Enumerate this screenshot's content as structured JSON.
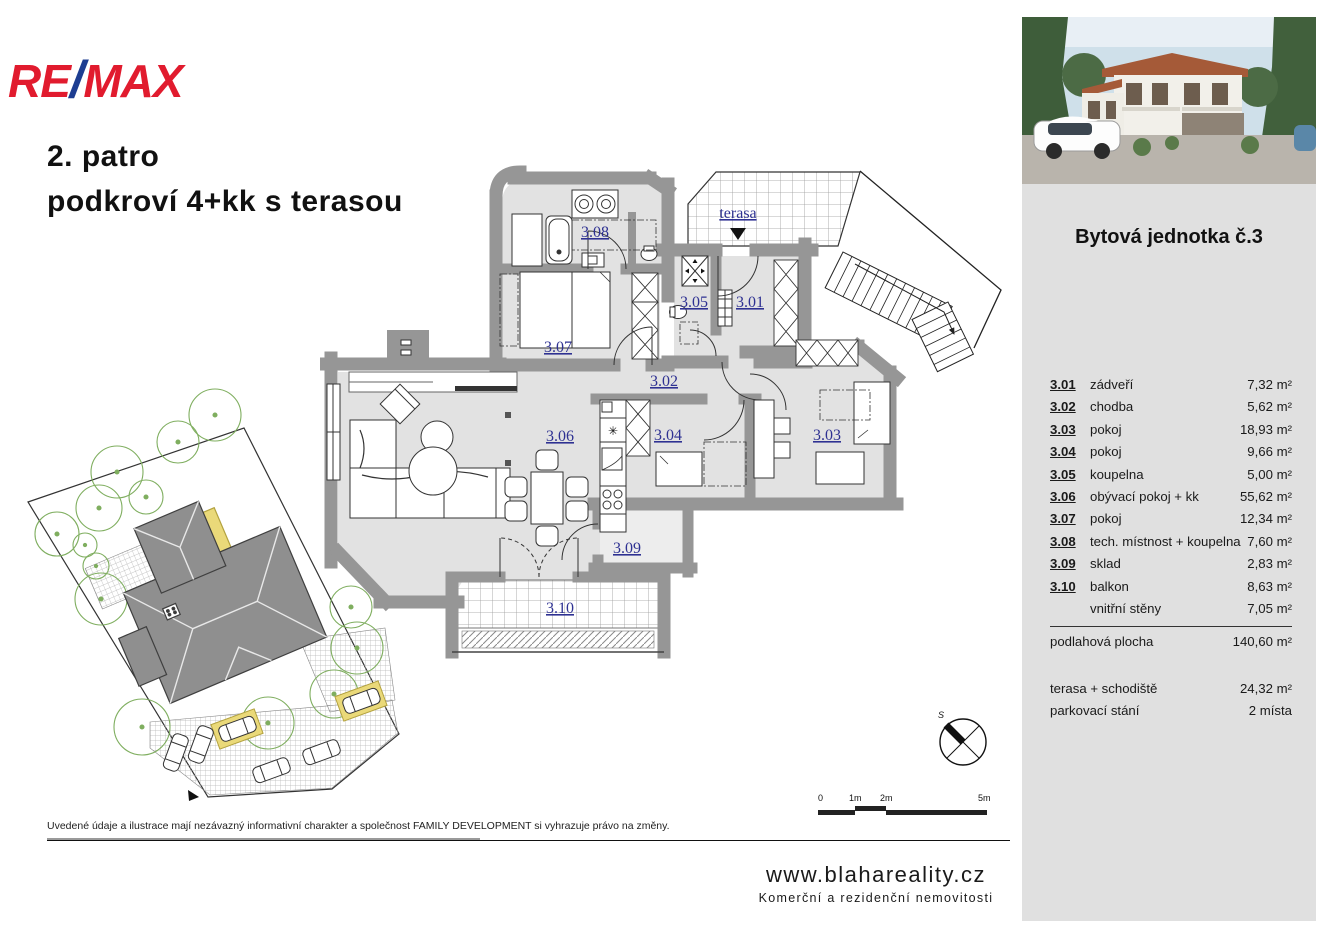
{
  "brand": {
    "re": "RE",
    "slash": "/",
    "max": "MAX"
  },
  "title": {
    "line1": "2. patro",
    "line2": "podkroví 4+kk s terasou"
  },
  "plan": {
    "labels": {
      "r301": "3.01",
      "r302": "3.02",
      "r303": "3.03",
      "r304": "3.04",
      "r305": "3.05",
      "r306": "3.06",
      "r307": "3.07",
      "r308": "3.08",
      "r309": "3.09",
      "r310": "3.10",
      "terasa": "terasa"
    },
    "icons": {
      "cooktop_star": "✳"
    }
  },
  "scalebar": {
    "t0": "0",
    "t1": "1m",
    "t2": "2m",
    "t5": "5m"
  },
  "compass": {
    "north": "S"
  },
  "disclaimer": "Uvedené údaje a ilustrace mají nezávazný informativní charakter a společnost FAMILY DEVELOPMENT si vyhrazuje právo na změny.",
  "footer": {
    "site": "www.blahareality.cz",
    "tagline": "Komerční a rezidenční nemovitosti"
  },
  "sidebar": {
    "unit_title": "Bytová jednotka č.3",
    "rooms": [
      {
        "num": "3.01",
        "name": "zádveří",
        "area": "7,32 m²"
      },
      {
        "num": "3.02",
        "name": "chodba",
        "area": "5,62 m²"
      },
      {
        "num": "3.03",
        "name": "pokoj",
        "area": "18,93 m²"
      },
      {
        "num": "3.04",
        "name": "pokoj",
        "area": "9,66 m²"
      },
      {
        "num": "3.05",
        "name": "koupelna",
        "area": "5,00 m²"
      },
      {
        "num": "3.06",
        "name": "obývací pokoj + kk",
        "area": "55,62 m²"
      },
      {
        "num": "3.07",
        "name": "pokoj",
        "area": "12,34 m²"
      },
      {
        "num": "3.08",
        "name": "tech. místnost + koupelna",
        "area": "7,60 m²"
      },
      {
        "num": "3.09",
        "name": "sklad",
        "area": "2,83 m²"
      },
      {
        "num": "3.10",
        "name": "balkon",
        "area": "8,63 m²"
      },
      {
        "num": "",
        "name": "vnitřní stěny",
        "area": "7,05 m²"
      }
    ],
    "total": {
      "name": "podlahová plocha",
      "area": "140,60 m²"
    },
    "extras": [
      {
        "name": "terasa + schodiště",
        "area": "24,32 m²"
      },
      {
        "name": "parkovací stání",
        "area": "2 místa"
      }
    ]
  }
}
